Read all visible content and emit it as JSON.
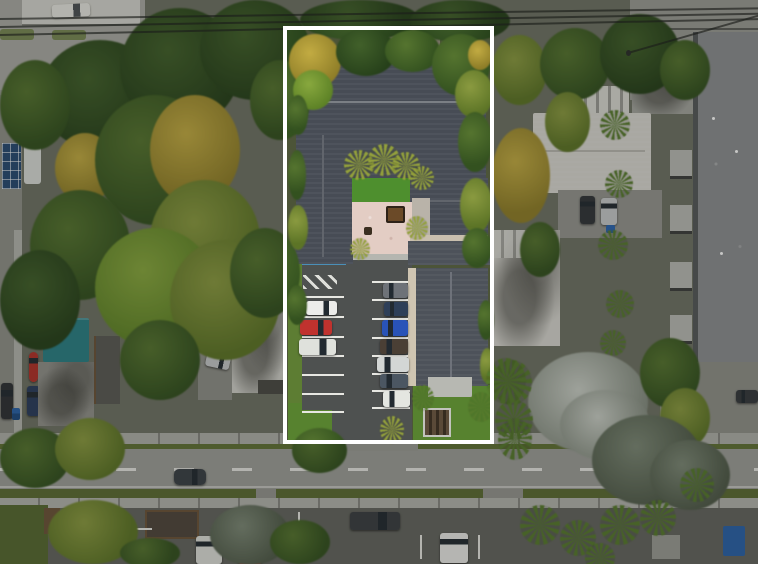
{
  "meta": {
    "type": "aerial-drone-photo",
    "description": "Aerial real-estate photo of a multi-unit property highlighted by a white boundary rectangle; surrounding neighborhood is dimmed",
    "orientation": "top-down"
  },
  "outline": {
    "label": "highlighted property boundary",
    "color": "#ffffff",
    "dim_overlay_color": "rgba(26,28,24,0.25)"
  },
  "highlighted_property": {
    "main_building": {
      "roof_color": "#474c55",
      "shape": "U-shaped around courtyard"
    },
    "annex_building": {
      "roof_color": "#4d525a"
    },
    "courtyard": {
      "turf_color": "#4e8f2e",
      "patio_color": "#e3cdc4",
      "furniture": [
        "dining-table-set",
        "fire-pit"
      ],
      "palm_trees": 5
    },
    "parking_lot": {
      "surface_color": "#4e5150",
      "line_color": "#e7e7e2",
      "blue_curb_color": "#4a8fb8",
      "cars_left_column": [
        "white-car",
        "red-car",
        "white-van"
      ],
      "cars_right_column": [
        "gray-suv",
        "navy-car",
        "blue-car",
        "dark-brown-car",
        "silver-car",
        "gray-blue-car",
        "white-van"
      ]
    },
    "backyard": [
      "lawn",
      "concrete-pad",
      "slatted-pergola",
      "palm-trees"
    ]
  },
  "surroundings": {
    "street": {
      "position": "bottom",
      "center_line": "white-dashed",
      "moving_car": "dark-gray"
    },
    "left_neighborhood": [
      "swimming-pool",
      "solar-panel-array",
      "teal-roof-house",
      "gray-roof-house",
      "white-roof-house",
      "parked-cars",
      "dense-trees"
    ],
    "right_neighborhood": [
      "white-roof-house",
      "striped-carport",
      "large-gray-apartment-roof",
      "white-blossom-tree",
      "palm-trees",
      "parked-cars"
    ],
    "bottom_neighborhood": [
      "parking-lots",
      "white-van",
      "red-car",
      "white-car",
      "dark-van",
      "blue-tarp",
      "palm-trees"
    ],
    "utilities": "overhead power lines across the top"
  },
  "palette": {
    "ground": "#6e7264",
    "road": "#9c9e98",
    "sidewalk": "#b2b3ad",
    "grass_verge": "#5b6b33",
    "pool_water": "#3f82b4",
    "solar_panels": "#274a72",
    "teal_roof": "#2a7f85",
    "apartment_roof": "#8b8e90"
  }
}
